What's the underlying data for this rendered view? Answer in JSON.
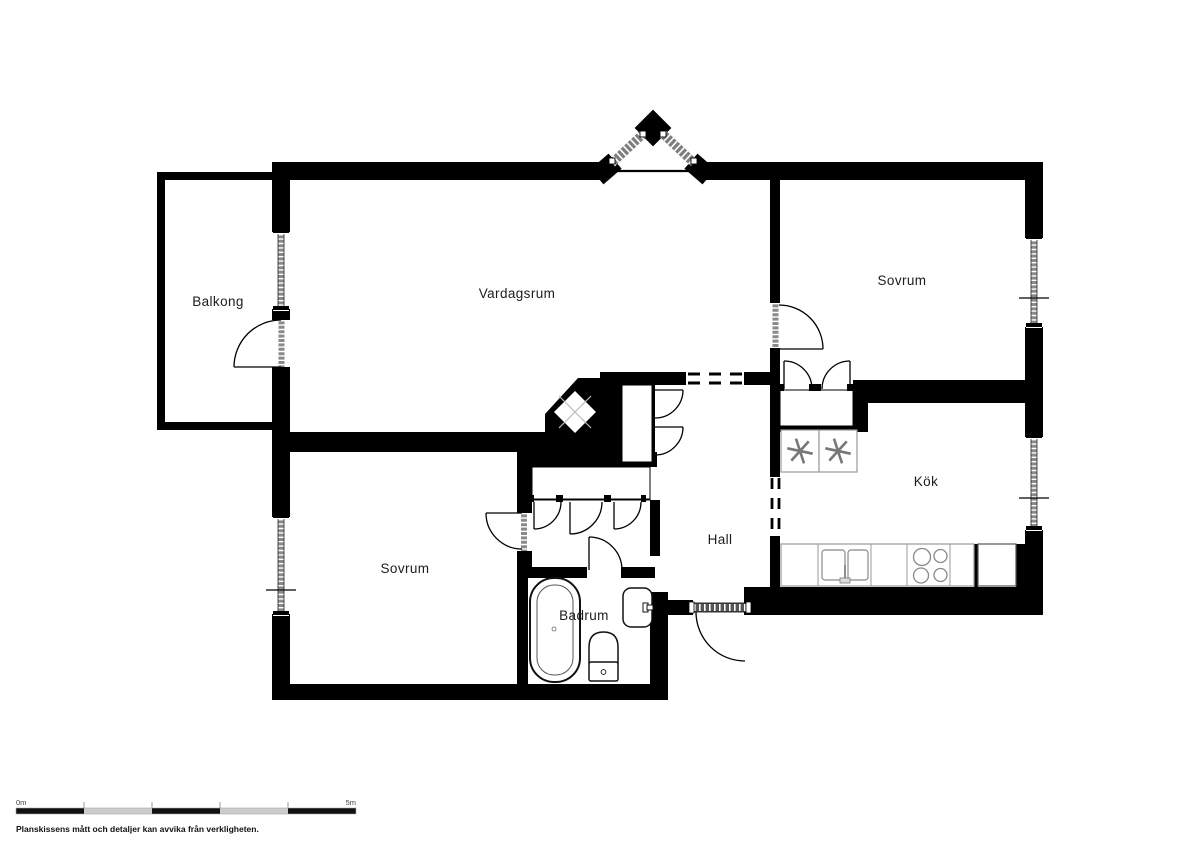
{
  "plan": {
    "rooms": {
      "balkong": {
        "label": "Balkong"
      },
      "vardagsrum": {
        "label": "Vardagsrum"
      },
      "sovrum_top": {
        "label": "Sovrum"
      },
      "kok": {
        "label": "Kök"
      },
      "hall": {
        "label": "Hall"
      },
      "sovrum_bottom": {
        "label": "Sovrum"
      },
      "badrum": {
        "label": "Badrum"
      }
    },
    "scale_bar": {
      "start_label": "0m",
      "end_label": "5m"
    },
    "disclaimer": "Planskissens mått och detaljer kan avvika från verkligheten.",
    "colors": {
      "wall": "#000000",
      "window_glass": "#8a8a8a",
      "fixture_line": "#888888",
      "background": "#ffffff"
    }
  }
}
